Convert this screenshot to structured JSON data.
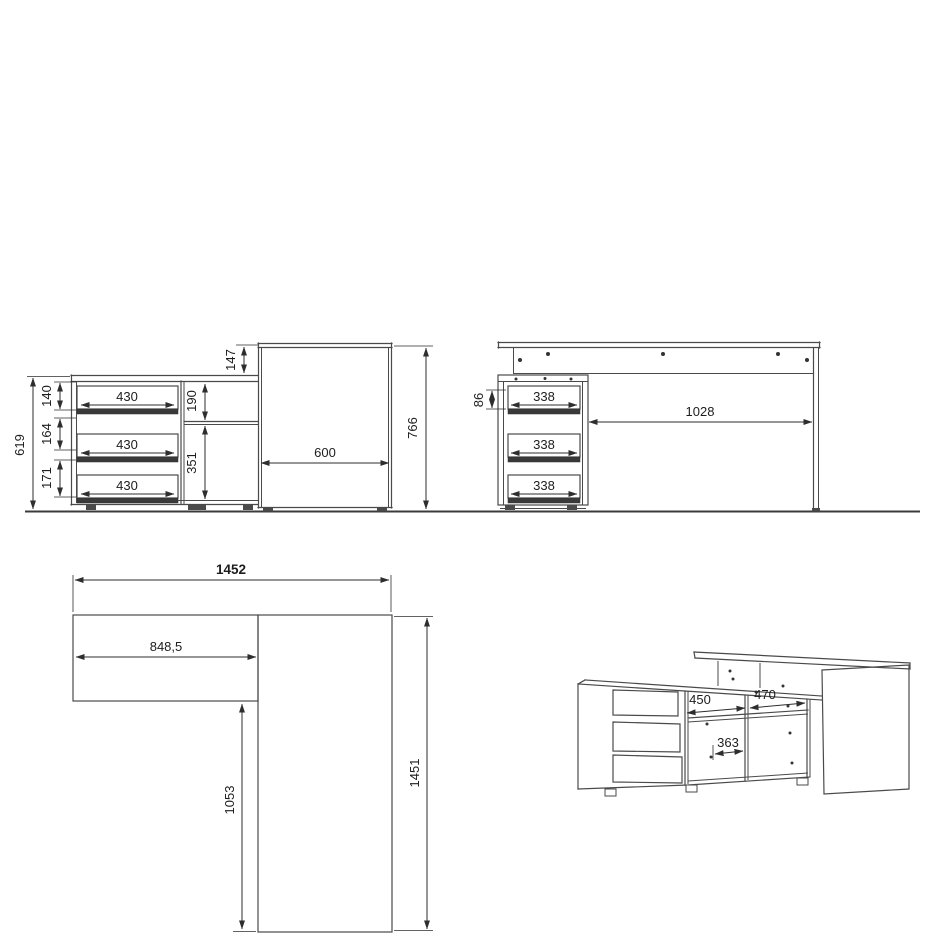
{
  "title": "corner desk technical dimension drawing",
  "units": "mm",
  "colors": {
    "background": "#ffffff",
    "outline": "#4a4a4a",
    "dimension": "#2e2e2e",
    "text": "#1d1d1d"
  },
  "views": {
    "front": {
      "name": "front elevation (cabinet + desk side)",
      "dims": {
        "cabinet_height": "619",
        "gap_top": "140",
        "gap_mid": "164",
        "gap_bottom": "171",
        "drawer_1": "430",
        "drawer_2": "430",
        "drawer_3": "430",
        "top_offset": "147",
        "shelf_upper": "190",
        "shelf_lower": "351",
        "desk_depth": "600",
        "desk_height": "766"
      }
    },
    "side": {
      "name": "front elevation (desk with drawer unit)",
      "dims": {
        "drawer_front_height": "86",
        "drawer_1": "338",
        "drawer_2": "338",
        "drawer_3": "338",
        "knee_clearance": "1028"
      }
    },
    "plan": {
      "name": "top plan view (L-shape)",
      "dims": {
        "overall_width": "1452",
        "return_length": "848,5",
        "side_run": "1053",
        "overall_depth": "1451"
      }
    },
    "iso": {
      "name": "perspective view",
      "dims": {
        "shelf_left": "450",
        "shelf_right": "470",
        "niche": "363"
      }
    }
  }
}
